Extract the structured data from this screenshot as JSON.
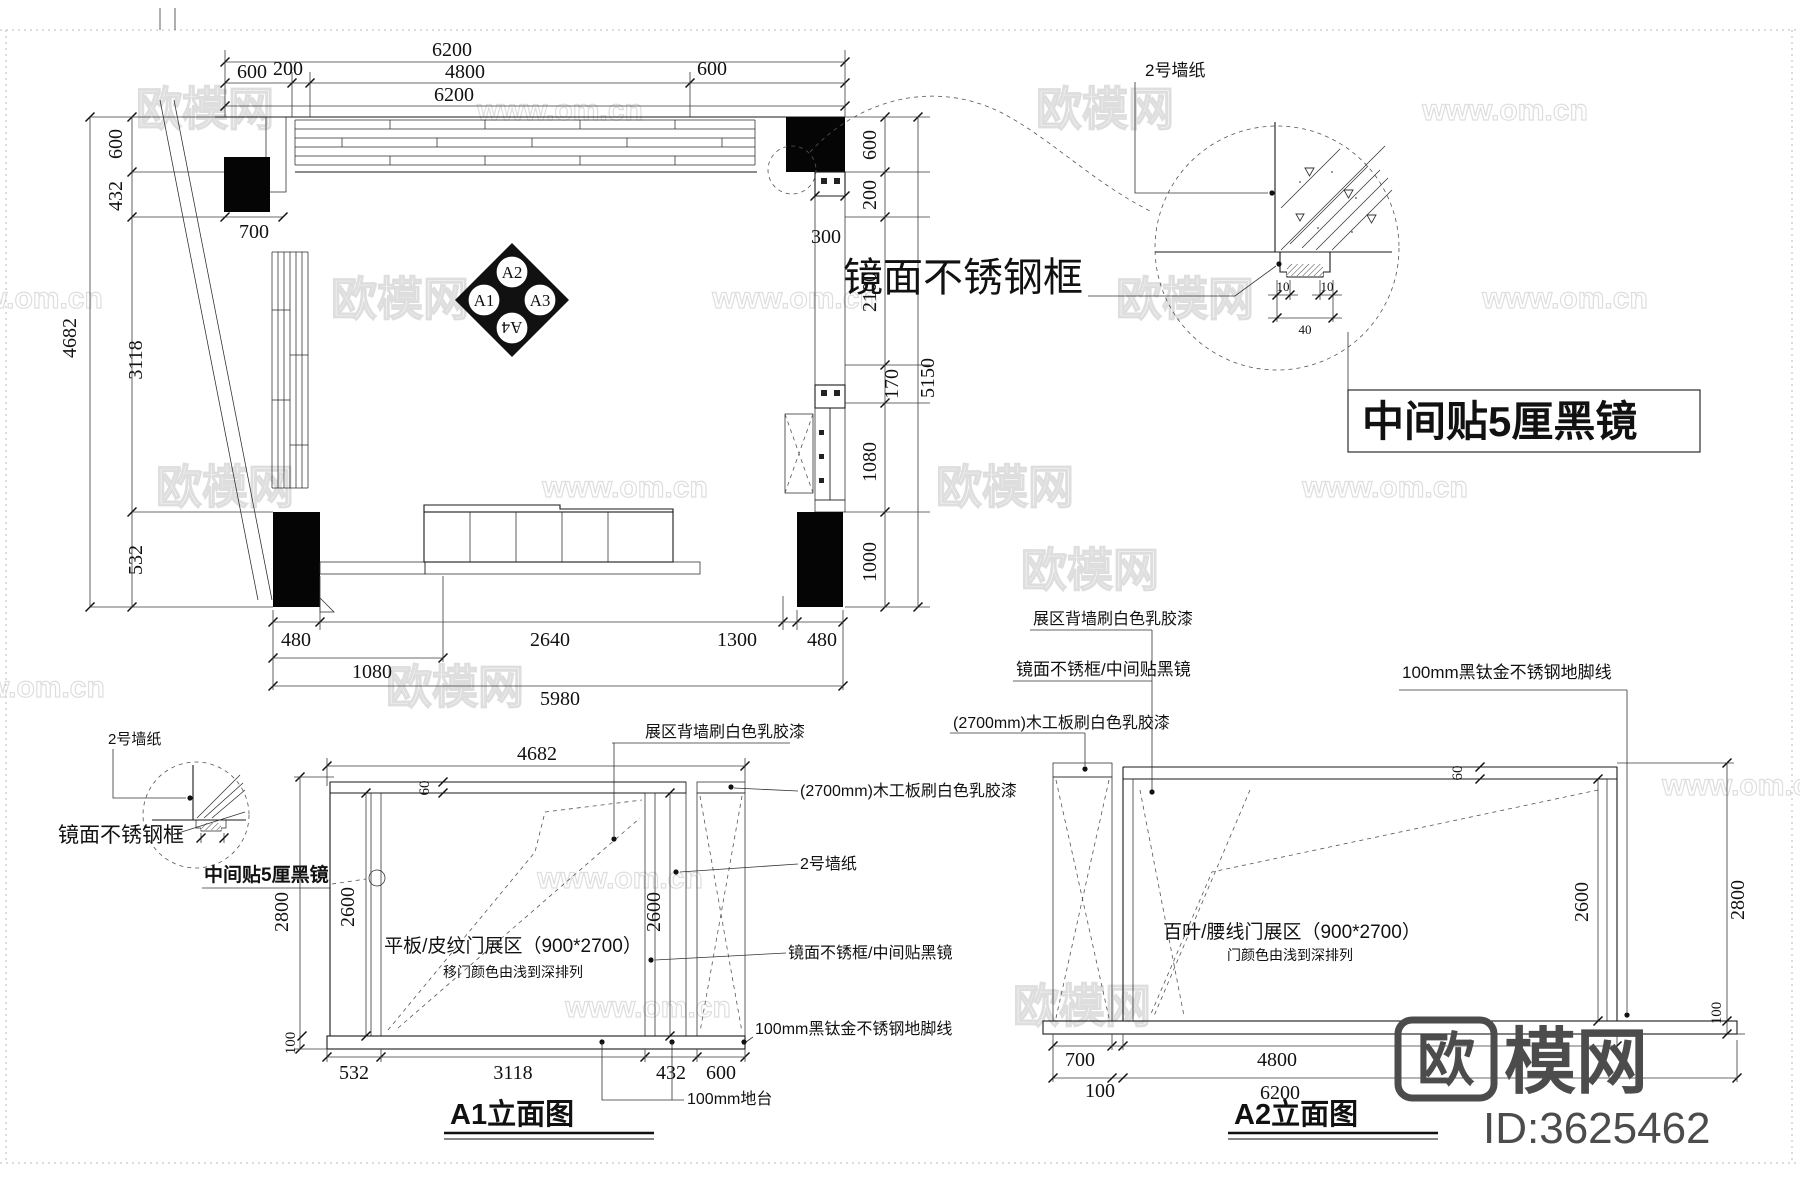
{
  "watermark": {
    "logo": "欧模网",
    "url": "www.om.cn"
  },
  "brand": {
    "logo_first": "欧",
    "logo_rest": "模网",
    "id_text": "ID:3625462"
  },
  "plan": {
    "dims_top": {
      "overall": "6200",
      "seg600l": "600",
      "seg200": "200",
      "seg4800": "4800",
      "seg600r": "600",
      "overall2": "6200"
    },
    "dims_left": {
      "overall": "4682",
      "seg600": "600",
      "seg432": "432",
      "seg3118": "3118",
      "seg532": "532",
      "seg700": "700"
    },
    "dims_right": {
      "seg600": "600",
      "seg200": "200",
      "wall300": "300",
      "seg2100": "2100",
      "seg170": "170",
      "overall": "5150",
      "seg1080": "1080",
      "seg1000": "1000"
    },
    "dims_bottom": {
      "seg480l": "480",
      "seg2640": "2640",
      "seg1300": "1300",
      "seg480r": "480",
      "seg1080": "1080",
      "overall": "5980"
    },
    "marker": {
      "top": "A2",
      "left": "A1",
      "right": "A3",
      "bottom": "A4"
    }
  },
  "detail": {
    "wallpaper": "2号墙纸",
    "frame_label": "镜面不锈钢框",
    "mirror_label": "中间贴5厘黑镜",
    "d10l": "10",
    "d10r": "10",
    "d40": "40"
  },
  "a1": {
    "title": "A1立面图",
    "zone_line1": "平板/皮纹门展区（900*2700）",
    "zone_line2": "移门颜色由浅到深排列",
    "labels": {
      "back_wall": "展区背墙刷白色乳胶漆",
      "board": "(2700mm)木工板刷白色乳胶漆",
      "wallpaper": "2号墙纸",
      "mirror": "镜面不锈框/中间贴黑镜",
      "skirting": "100mm黑钛金不锈钢地脚线",
      "platform": "100mm地台"
    },
    "dims": {
      "width": "4682",
      "frame60": "60",
      "h2800": "2800",
      "h2600l": "2600",
      "h2600r": "2600",
      "plat100": "100",
      "b532": "532",
      "b3118": "3118",
      "b432": "432",
      "b600": "600"
    }
  },
  "a2": {
    "title": "A2立面图",
    "zone_line1": "百叶/腰线门展区（900*2700）",
    "zone_line2": "门颜色由浅到深排列",
    "labels": {
      "back_wall": "展区背墙刷白色乳胶漆",
      "mirror": "镜面不锈框/中间贴黑镜",
      "board": "(2700mm)木工板刷白色乳胶漆",
      "skirting": "100mm黑钛金不锈钢地脚线"
    },
    "dims": {
      "frame60": "60",
      "h2600": "2600",
      "h2800": "2800",
      "plat100": "100",
      "b700": "700",
      "b100": "100",
      "b4800": "4800",
      "b6200": "6200"
    }
  }
}
